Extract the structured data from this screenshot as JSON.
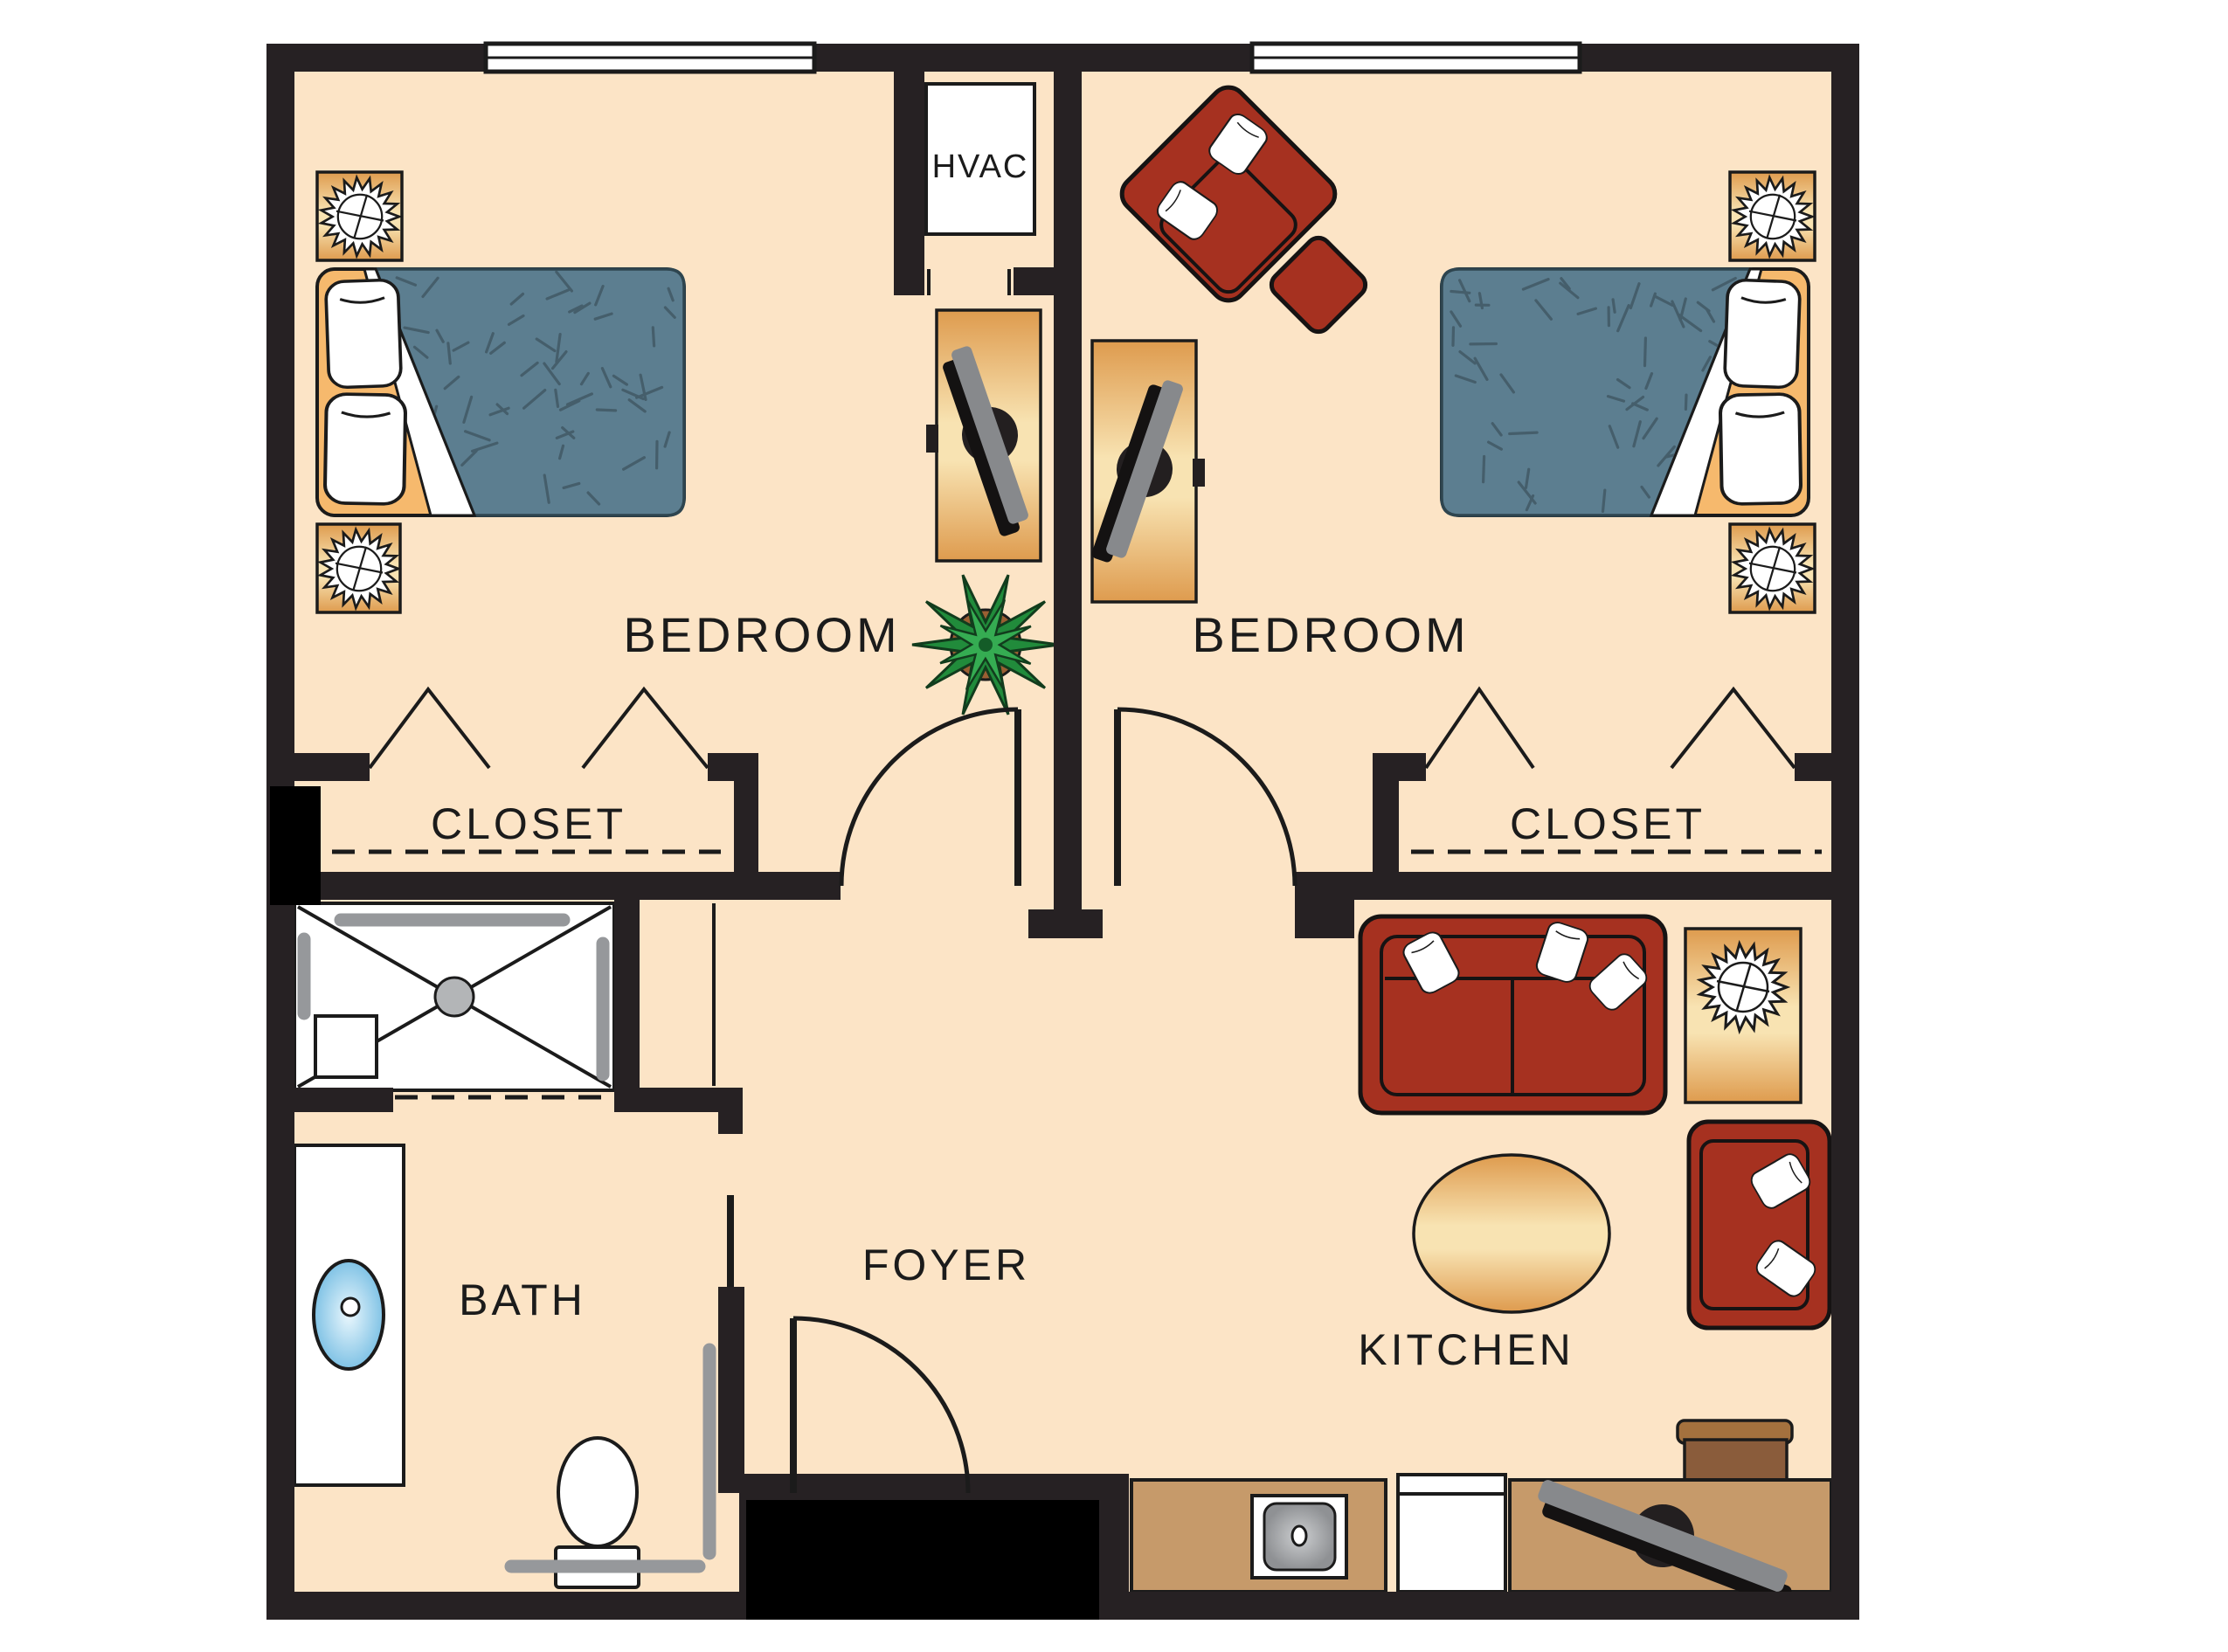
{
  "plan": {
    "title": "two-bedroom residence floor plan",
    "rooms": {
      "bedroom_left": {
        "label": "BEDROOM"
      },
      "bedroom_right": {
        "label": "BEDROOM"
      },
      "closet_left": {
        "label": "CLOSET"
      },
      "closet_right": {
        "label": "CLOSET"
      },
      "hvac": {
        "label": "HVAC"
      },
      "bath": {
        "label": "BATH"
      },
      "foyer": {
        "label": "FOYER"
      },
      "kitchen": {
        "label": "KITCHEN"
      }
    },
    "colors": {
      "wall": "#262123",
      "black": "#000000",
      "floor": "#FCE4C6",
      "ink": "#1B1B1B",
      "white": "#FFFFFF",
      "wood_dark": "#DE9B4E",
      "wood_light": "#F8E3B2",
      "headboard": "#F6B96D",
      "mattress": "#5C7E90",
      "mattress_edge": "#2E454F",
      "speckle": "#455E6B",
      "red": "#A63120",
      "counter": "#C69A6A",
      "brown": "#8A5C3B",
      "brown_light": "#A4713E",
      "gray_bar": "#96989B",
      "tv_gray": "#87898C",
      "sink_blue": "#7FC2E5",
      "sink_blue_light": "#EAF7FD",
      "steel_dark": "#8F9194",
      "steel_light": "#CDCFD1",
      "plant_dark": "#218B3B",
      "plant_light": "#35AC52",
      "pot": "#9A5F33"
    }
  }
}
